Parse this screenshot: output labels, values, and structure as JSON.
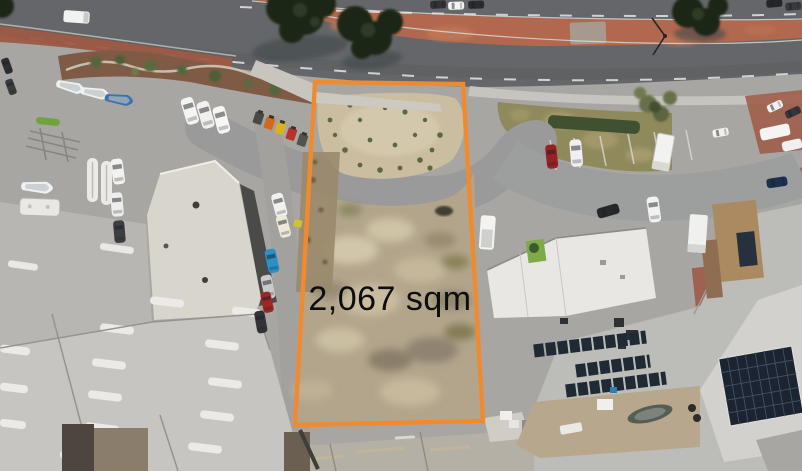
{
  "annotation": {
    "area_label": "2,067 sqm",
    "boundary_color": "#F08A30",
    "label_color": "#0D0D0D"
  },
  "palette": {
    "highway_asphalt": "#646669",
    "median_brick": "#B2684E",
    "street_asphalt": "#A8A6A2",
    "sand_lot": "#B2A58C",
    "sand_mound": "#CABDA0",
    "grass_verge": "#8F8A5C",
    "hedge_green": "#3F512E",
    "roof_light_grey": "#C7C5C1",
    "roof_white": "#E8E7E3",
    "solar_panel": "#202A35",
    "brick_paving": "#9D5B48",
    "garden_mulch": "#7F5A44"
  }
}
